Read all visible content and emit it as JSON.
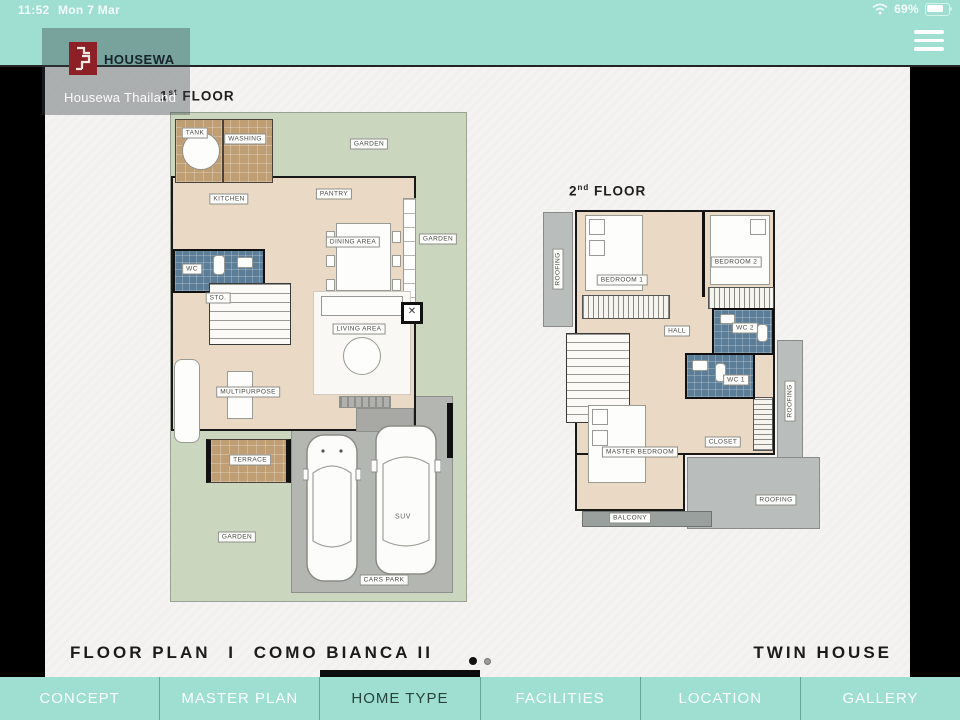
{
  "status_bar": {
    "time": "11:52",
    "date": "Mon 7 Mar",
    "battery_percent": "69%"
  },
  "header": {
    "brand": "HOUSEWA",
    "brand_subtitle": "Housewa Thailand"
  },
  "floor1": {
    "title": {
      "num": "1",
      "sup": "st",
      "word": " FLOOR"
    },
    "labels": {
      "tank": "TANK",
      "washing": "WASHING",
      "garden_top": "GARDEN",
      "kitchen": "KITCHEN",
      "pantry": "PANTRY",
      "dining": "DINING AREA",
      "garden_right": "GARDEN",
      "wc": "WC",
      "sto": "STO.",
      "living": "LIVING AREA",
      "multipurpose": "MULTIPURPOSE",
      "terrace": "TERRACE",
      "garden_bottom": "GARDEN",
      "suv": "SUV",
      "cars_park": "CARS PARK"
    }
  },
  "floor2": {
    "title": {
      "num": "2",
      "sup": "nd",
      "word": " FLOOR"
    },
    "labels": {
      "roofing_left": "ROOFING",
      "bedroom1": "BEDROOM 1",
      "bedroom2": "BEDROOM 2",
      "hall": "HALL",
      "wc2": "WC 2",
      "wc1": "WC 1",
      "master_bedroom": "MASTER BEDROOM",
      "closet": "CLOSET",
      "balcony": "BALCONY",
      "roofing_bottom": "ROOFING",
      "roofing_right": "ROOFING"
    }
  },
  "footer": {
    "section": "FLOOR PLAN",
    "divider": "I",
    "plan_name": "COMO BIANCA II",
    "house_type": "TWIN HOUSE"
  },
  "pagination": {
    "current": 1,
    "total": 2
  },
  "nav": {
    "items": [
      {
        "label": "CONCEPT",
        "active": false
      },
      {
        "label": "MASTER PLAN",
        "active": false
      },
      {
        "label": "HOME TYPE",
        "active": true
      },
      {
        "label": "FACILITIES",
        "active": false
      },
      {
        "label": "LOCATION",
        "active": false
      },
      {
        "label": "GALLERY",
        "active": false
      }
    ]
  },
  "colors": {
    "teal": "#9fdfd1",
    "logo_red": "#8c2026",
    "wc_blue": "#5c7d97",
    "garden_green": "#cbd6bf",
    "floor_beige": "#ead9c5",
    "service_brown": "#bf9e74",
    "carpark_gray": "#b4b6b2",
    "roofing_gray": "#b9bdbb",
    "active_tab_text": "#28423c"
  }
}
